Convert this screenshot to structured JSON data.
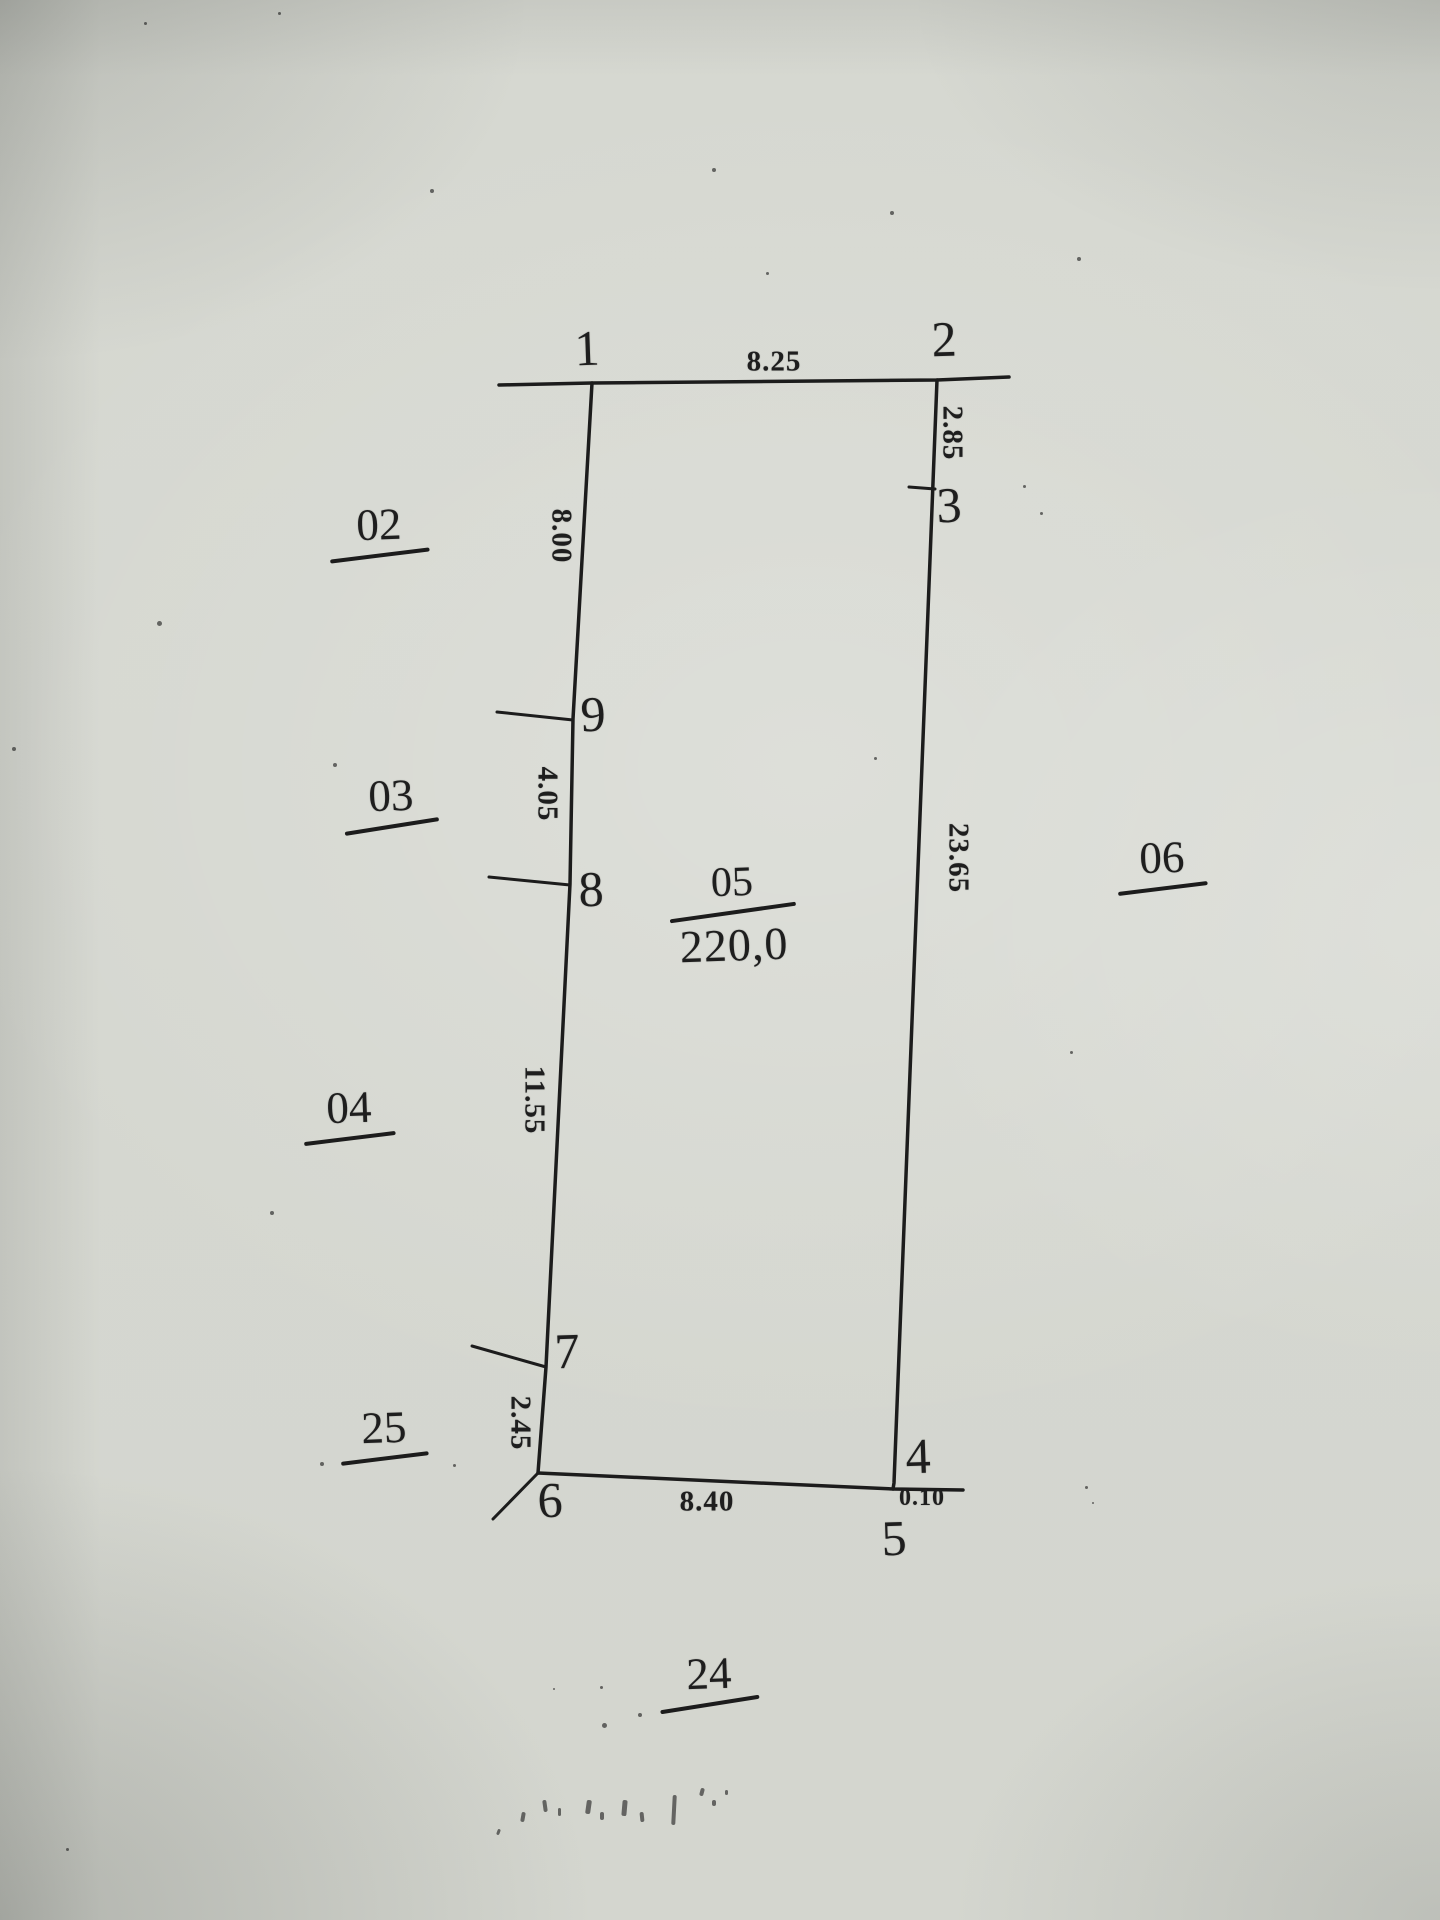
{
  "colors": {
    "paper": "#d6d8d1",
    "ink": "#1e1e1e"
  },
  "survey_sketch": {
    "parcel": {
      "number": "05",
      "area": "220,0",
      "vertices": {
        "p1": "1",
        "p2": "2",
        "p3": "3",
        "p4": "4",
        "p5": "5",
        "p6": "6",
        "p7": "7",
        "p8": "8",
        "p9": "9"
      },
      "edges": {
        "top": "8.25",
        "right_upper": "2.85",
        "right_main": "23.65",
        "bottom": "8.40",
        "bottom_corner": "0.10",
        "left_upper": "8.00",
        "left_second": "4.05",
        "left_third": "11.55",
        "left_bottom": "2.45"
      }
    },
    "adjacent_parcels": {
      "upper_left": "02",
      "left": "03",
      "lower_left": "04",
      "bottom_left": "25",
      "right": "06",
      "below": "24"
    }
  }
}
